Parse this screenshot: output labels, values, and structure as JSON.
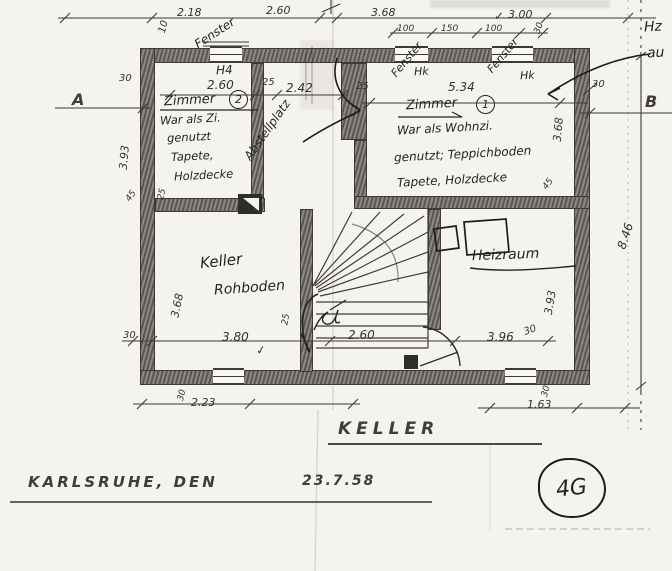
{
  "title_block": {
    "drawing_title": "KELLER",
    "city_date_label": "KARLSRUHE, DEN",
    "date": "23.7.58",
    "sheet_mark": "4G"
  },
  "section_markers": {
    "left": "A",
    "right": "B"
  },
  "corner_note": {
    "line1": "Hz",
    "line2": "au"
  },
  "rooms": {
    "zimmer2": {
      "name": "Zimmer",
      "number": "2",
      "note1": "War als Zi.",
      "note2": "genutzt",
      "note3": "Tapete,",
      "note4": "Holzdecke"
    },
    "zimmer1": {
      "name": "Zimmer",
      "number": "1",
      "note1": "War als Wohnzi.",
      "note2": "genutzt; Teppichboden",
      "note3": "Tapete, Holzdecke"
    },
    "keller": {
      "name": "Keller",
      "floor_note": "Rohboden"
    },
    "heizraum": {
      "name": "Heizraum"
    },
    "abstellplatz": {
      "name": "Abstellplatz"
    }
  },
  "window_labels": {
    "fenster_left": "Fenster",
    "fenster_mid": "Fenster",
    "fenster_right": "Fenster",
    "h4_left": "H4",
    "hk_mid": "Hk",
    "hk_right": "Hk"
  },
  "dimensions": {
    "top_row": {
      "d10": "10",
      "d218": "2.18",
      "d260": "2.60",
      "d368": "3.68",
      "d300": "3.00"
    },
    "top_sub_row": {
      "d100a": "100",
      "d150": "150",
      "d100b": "100",
      "d30": "30"
    },
    "upper_row": {
      "w30_left": "30",
      "d260": "2.60",
      "d25a": "25",
      "d242": "2.42",
      "d25b": "25",
      "d534": "5.34",
      "w30_right": "30"
    },
    "verticals": {
      "left_393": "3.93",
      "left_45": "45",
      "left_25": "25",
      "left_368": "3.68",
      "right_368": "3.68",
      "right_45": "45",
      "right_393": "3.93",
      "overall_846": "8.46",
      "stair_25": "25"
    },
    "lower_row": {
      "w30_left": "30",
      "d380": "3.80",
      "d260_stair": "2.60",
      "d396": "3.96",
      "w30_right": "30"
    },
    "below_row": {
      "v30_left": "30",
      "d223": "2.23",
      "v30_right": "30",
      "d163": "1.63"
    }
  },
  "marks": {
    "check": "✓"
  },
  "colors": {
    "paper": "#f5f3ee",
    "ink": "#26241f",
    "wall_gray": "#7a756e"
  }
}
